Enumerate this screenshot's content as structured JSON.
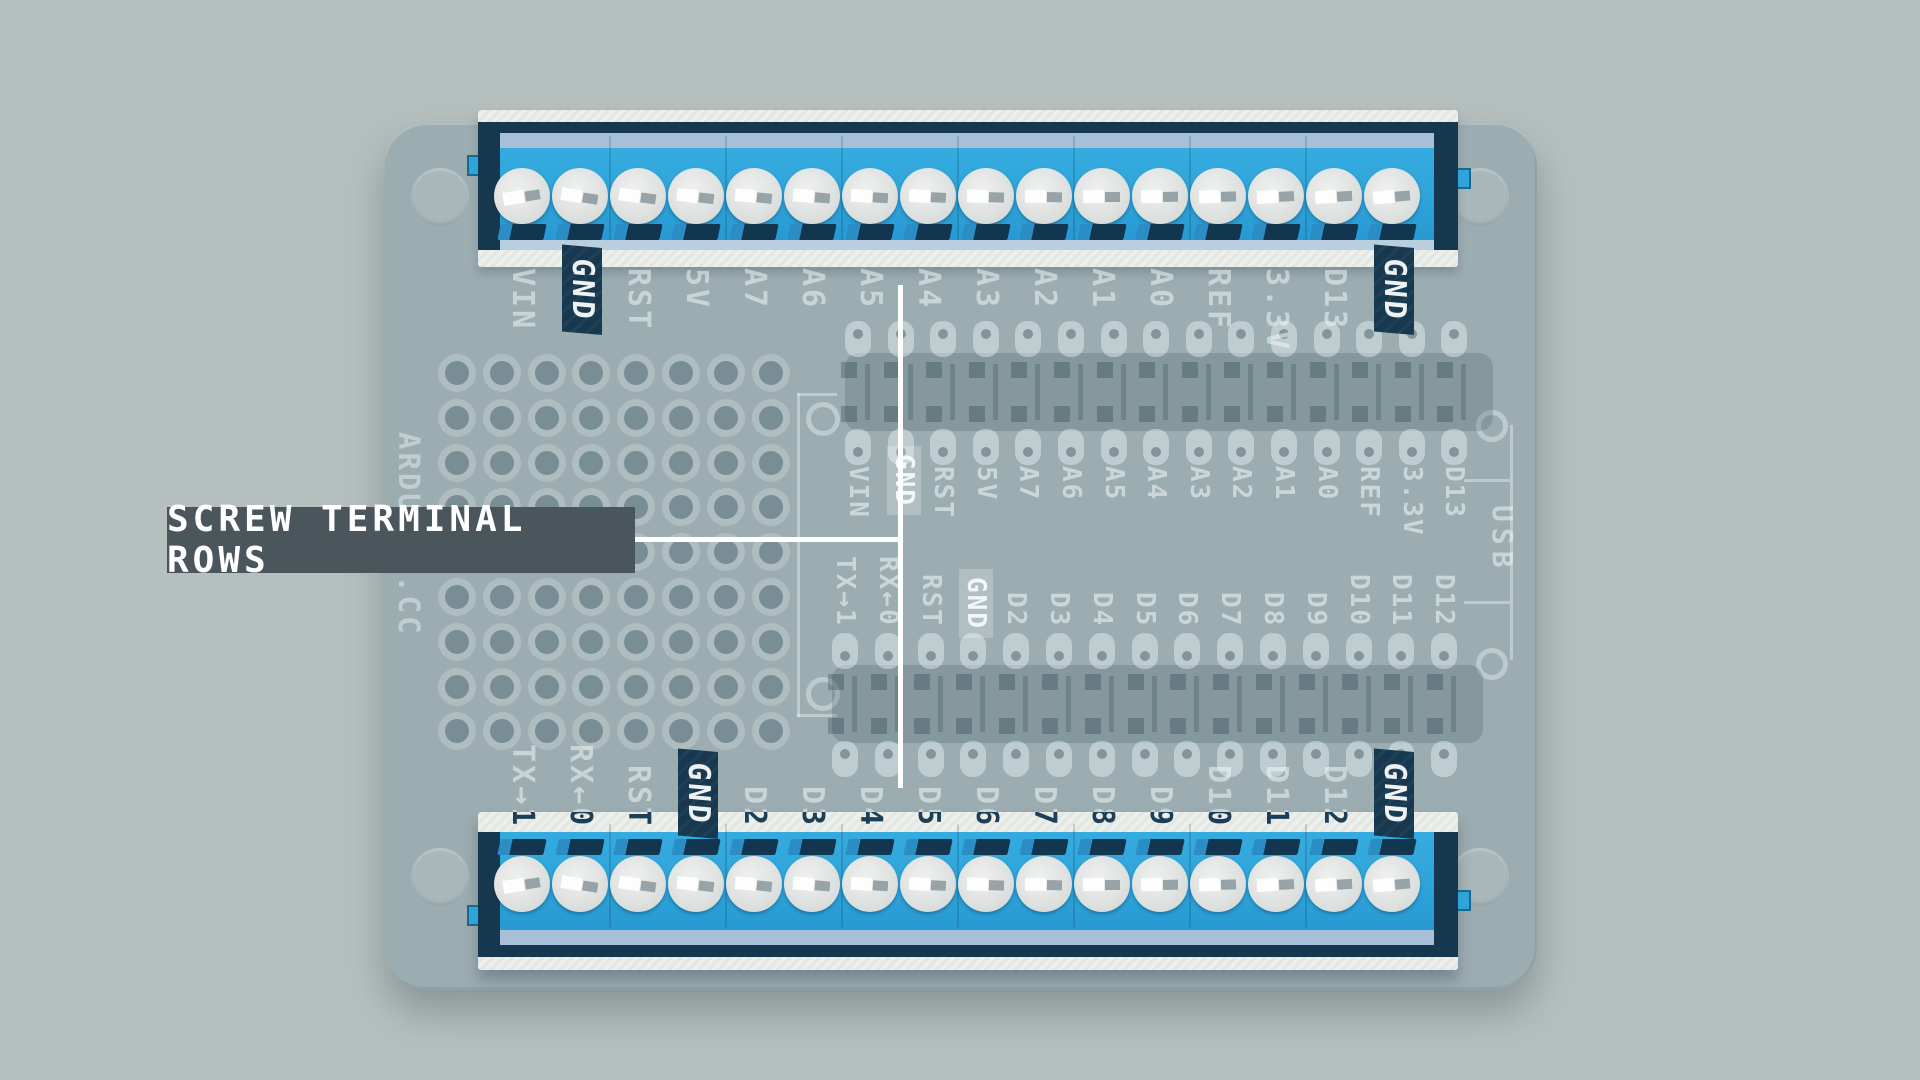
{
  "annotation": {
    "label": "SCREW TERMINAL ROWS"
  },
  "silkscreen": {
    "brand": "ARDUINO.CC",
    "usb": "USB"
  },
  "terminal_rows": {
    "screws_per_row": 16,
    "top": {
      "labels": [
        "VIN",
        "GND",
        "RST",
        "5V",
        "A7",
        "A6",
        "A5",
        "A4",
        "A3",
        "A2",
        "A1",
        "A0",
        "REF",
        "3.3V",
        "D13",
        "GND"
      ]
    },
    "bottom": {
      "labels": [
        "TX→1",
        "RX←0",
        "RST",
        "GND",
        "D2",
        "D3",
        "D4",
        "D5",
        "D6",
        "D7",
        "D8",
        "D9",
        "D10",
        "D11",
        "D12",
        "GND"
      ]
    }
  },
  "headers": {
    "top": {
      "labels": [
        "VIN",
        "GND",
        "RST",
        "5V",
        "A7",
        "A6",
        "A5",
        "A4",
        "A3",
        "A2",
        "A1",
        "A0",
        "REF",
        "3.3V",
        "D13"
      ]
    },
    "bottom": {
      "labels": [
        "TX→1",
        "RX←0",
        "RST",
        "GND",
        "D2",
        "D3",
        "D4",
        "D5",
        "D6",
        "D7",
        "D8",
        "D9",
        "D10",
        "D11",
        "D12"
      ]
    }
  },
  "colors": {
    "background": "#b4bfbe",
    "board": "#9cadb2",
    "terminal_blue": "#2da4da",
    "terminal_navy": "#16384e",
    "backing_white": "#edefeb",
    "annotation_bg": "#4a555c",
    "annotation_line": "#ffffff"
  }
}
